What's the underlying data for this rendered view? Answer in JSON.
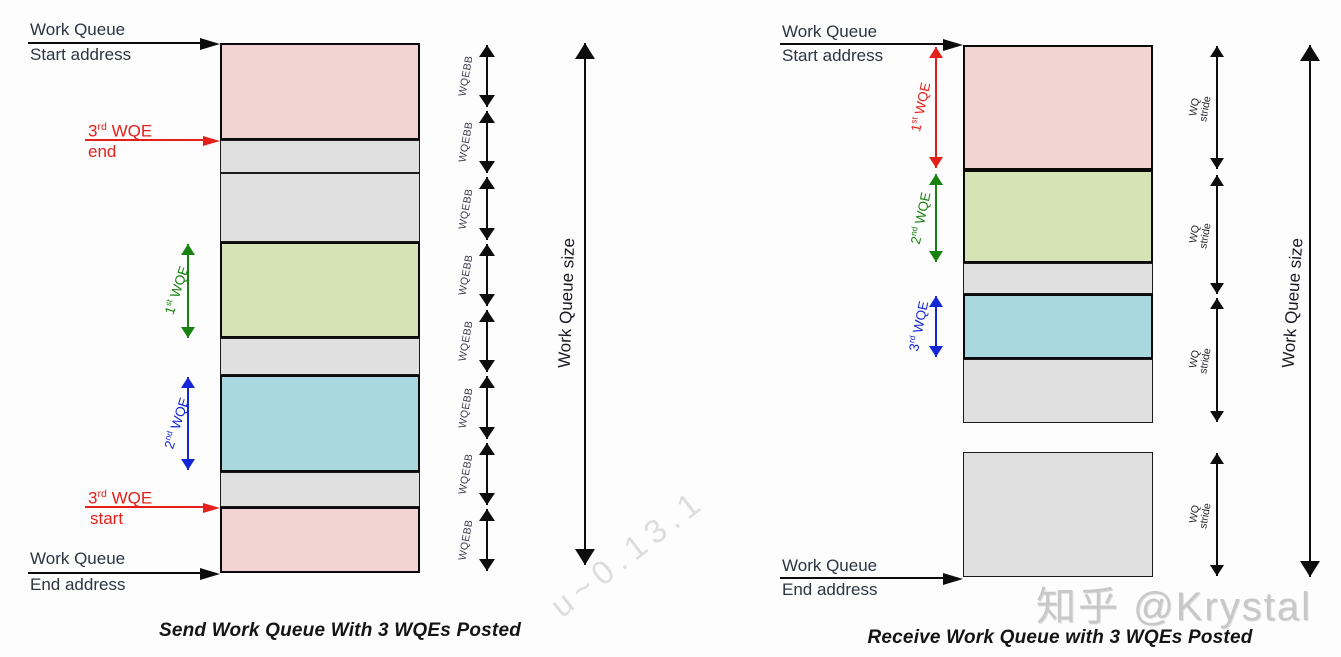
{
  "colors": {
    "wqe_pink": "#f2d5d3",
    "wqe_green": "#d6e3b4",
    "wqe_blue": "#aad8e0",
    "free_block": "#e0e0e0",
    "arrow_red": "#e3201b",
    "arrow_green": "#17820f",
    "arrow_blue": "#1427d6"
  },
  "left_diagram": {
    "caption": "Send Work Queue With 3 WQEs Posted",
    "start_address": {
      "line1": "Work Queue",
      "line2": "Start address"
    },
    "end_address": {
      "line1": "Work Queue",
      "line2": "End address"
    },
    "wqe3_end": {
      "base": "3",
      "sup": "rd",
      "rest": " WQE",
      "line2": "end"
    },
    "wqe3_start": {
      "base": "3",
      "sup": "rd",
      "rest": " WQE",
      "line2": "start"
    },
    "wqe1_label": {
      "base": "1",
      "sup": "st",
      "rest": " WQE"
    },
    "wqe2_label": {
      "base": "2",
      "sup": "nd",
      "rest": " WQE"
    },
    "wqebb_label": "WQEBB",
    "size_label": "Work Queue size",
    "wqebb_boundaries": [
      43,
      109,
      175,
      242,
      308,
      374,
      441,
      507,
      573
    ],
    "blocks": [
      {
        "kind": "wqe",
        "color": "pink",
        "from": 43,
        "to": 140,
        "role": "3rd WQE end (wrapped)"
      },
      {
        "kind": "free",
        "from": 140,
        "to": 173
      },
      {
        "kind": "free",
        "from": 173,
        "to": 242
      },
      {
        "kind": "wqe",
        "color": "green",
        "from": 242,
        "to": 338,
        "role": "1st WQE"
      },
      {
        "kind": "free",
        "from": 338,
        "to": 375
      },
      {
        "kind": "wqe",
        "color": "blue",
        "from": 375,
        "to": 472,
        "role": "2nd WQE"
      },
      {
        "kind": "free",
        "from": 472,
        "to": 507
      },
      {
        "kind": "wqe",
        "color": "pink",
        "from": 507,
        "to": 573,
        "role": "3rd WQE start"
      }
    ]
  },
  "right_diagram": {
    "caption": "Receive Work Queue with 3 WQEs Posted",
    "start_address": {
      "line1": "Work Queue",
      "line2": "Start address"
    },
    "end_address": {
      "line1": "Work Queue",
      "line2": "End address"
    },
    "wqe1_label": {
      "base": "1",
      "sup": "st",
      "rest": " WQE"
    },
    "wqe2_label": {
      "base": "2",
      "sup": "nd",
      "rest": " WQE"
    },
    "wqe3_label": {
      "base": "3",
      "sup": "rd",
      "rest": " WQE"
    },
    "stride_label": {
      "line1": "WQ",
      "line2": "stride"
    },
    "size_label": "Work Queue size",
    "stride_segments": [
      [
        45,
        170
      ],
      [
        174,
        295
      ],
      [
        297,
        423
      ],
      [
        452,
        577
      ]
    ],
    "blocks": [
      {
        "kind": "wqe",
        "color": "pink",
        "from": 45,
        "to": 170,
        "role": "1st WQE"
      },
      {
        "kind": "wqe",
        "color": "green",
        "from": 170,
        "to": 263,
        "role": "2nd WQE"
      },
      {
        "kind": "free",
        "from": 263,
        "to": 294
      },
      {
        "kind": "wqe",
        "color": "blue",
        "from": 294,
        "to": 359,
        "role": "3rd WQE"
      },
      {
        "kind": "free",
        "from": 359,
        "to": 423
      },
      {
        "kind": "free",
        "from": 452,
        "to": 577
      }
    ]
  },
  "watermarks": {
    "zhihu": "知乎 @Krystal",
    "diagonal": "u~0.13.1"
  }
}
